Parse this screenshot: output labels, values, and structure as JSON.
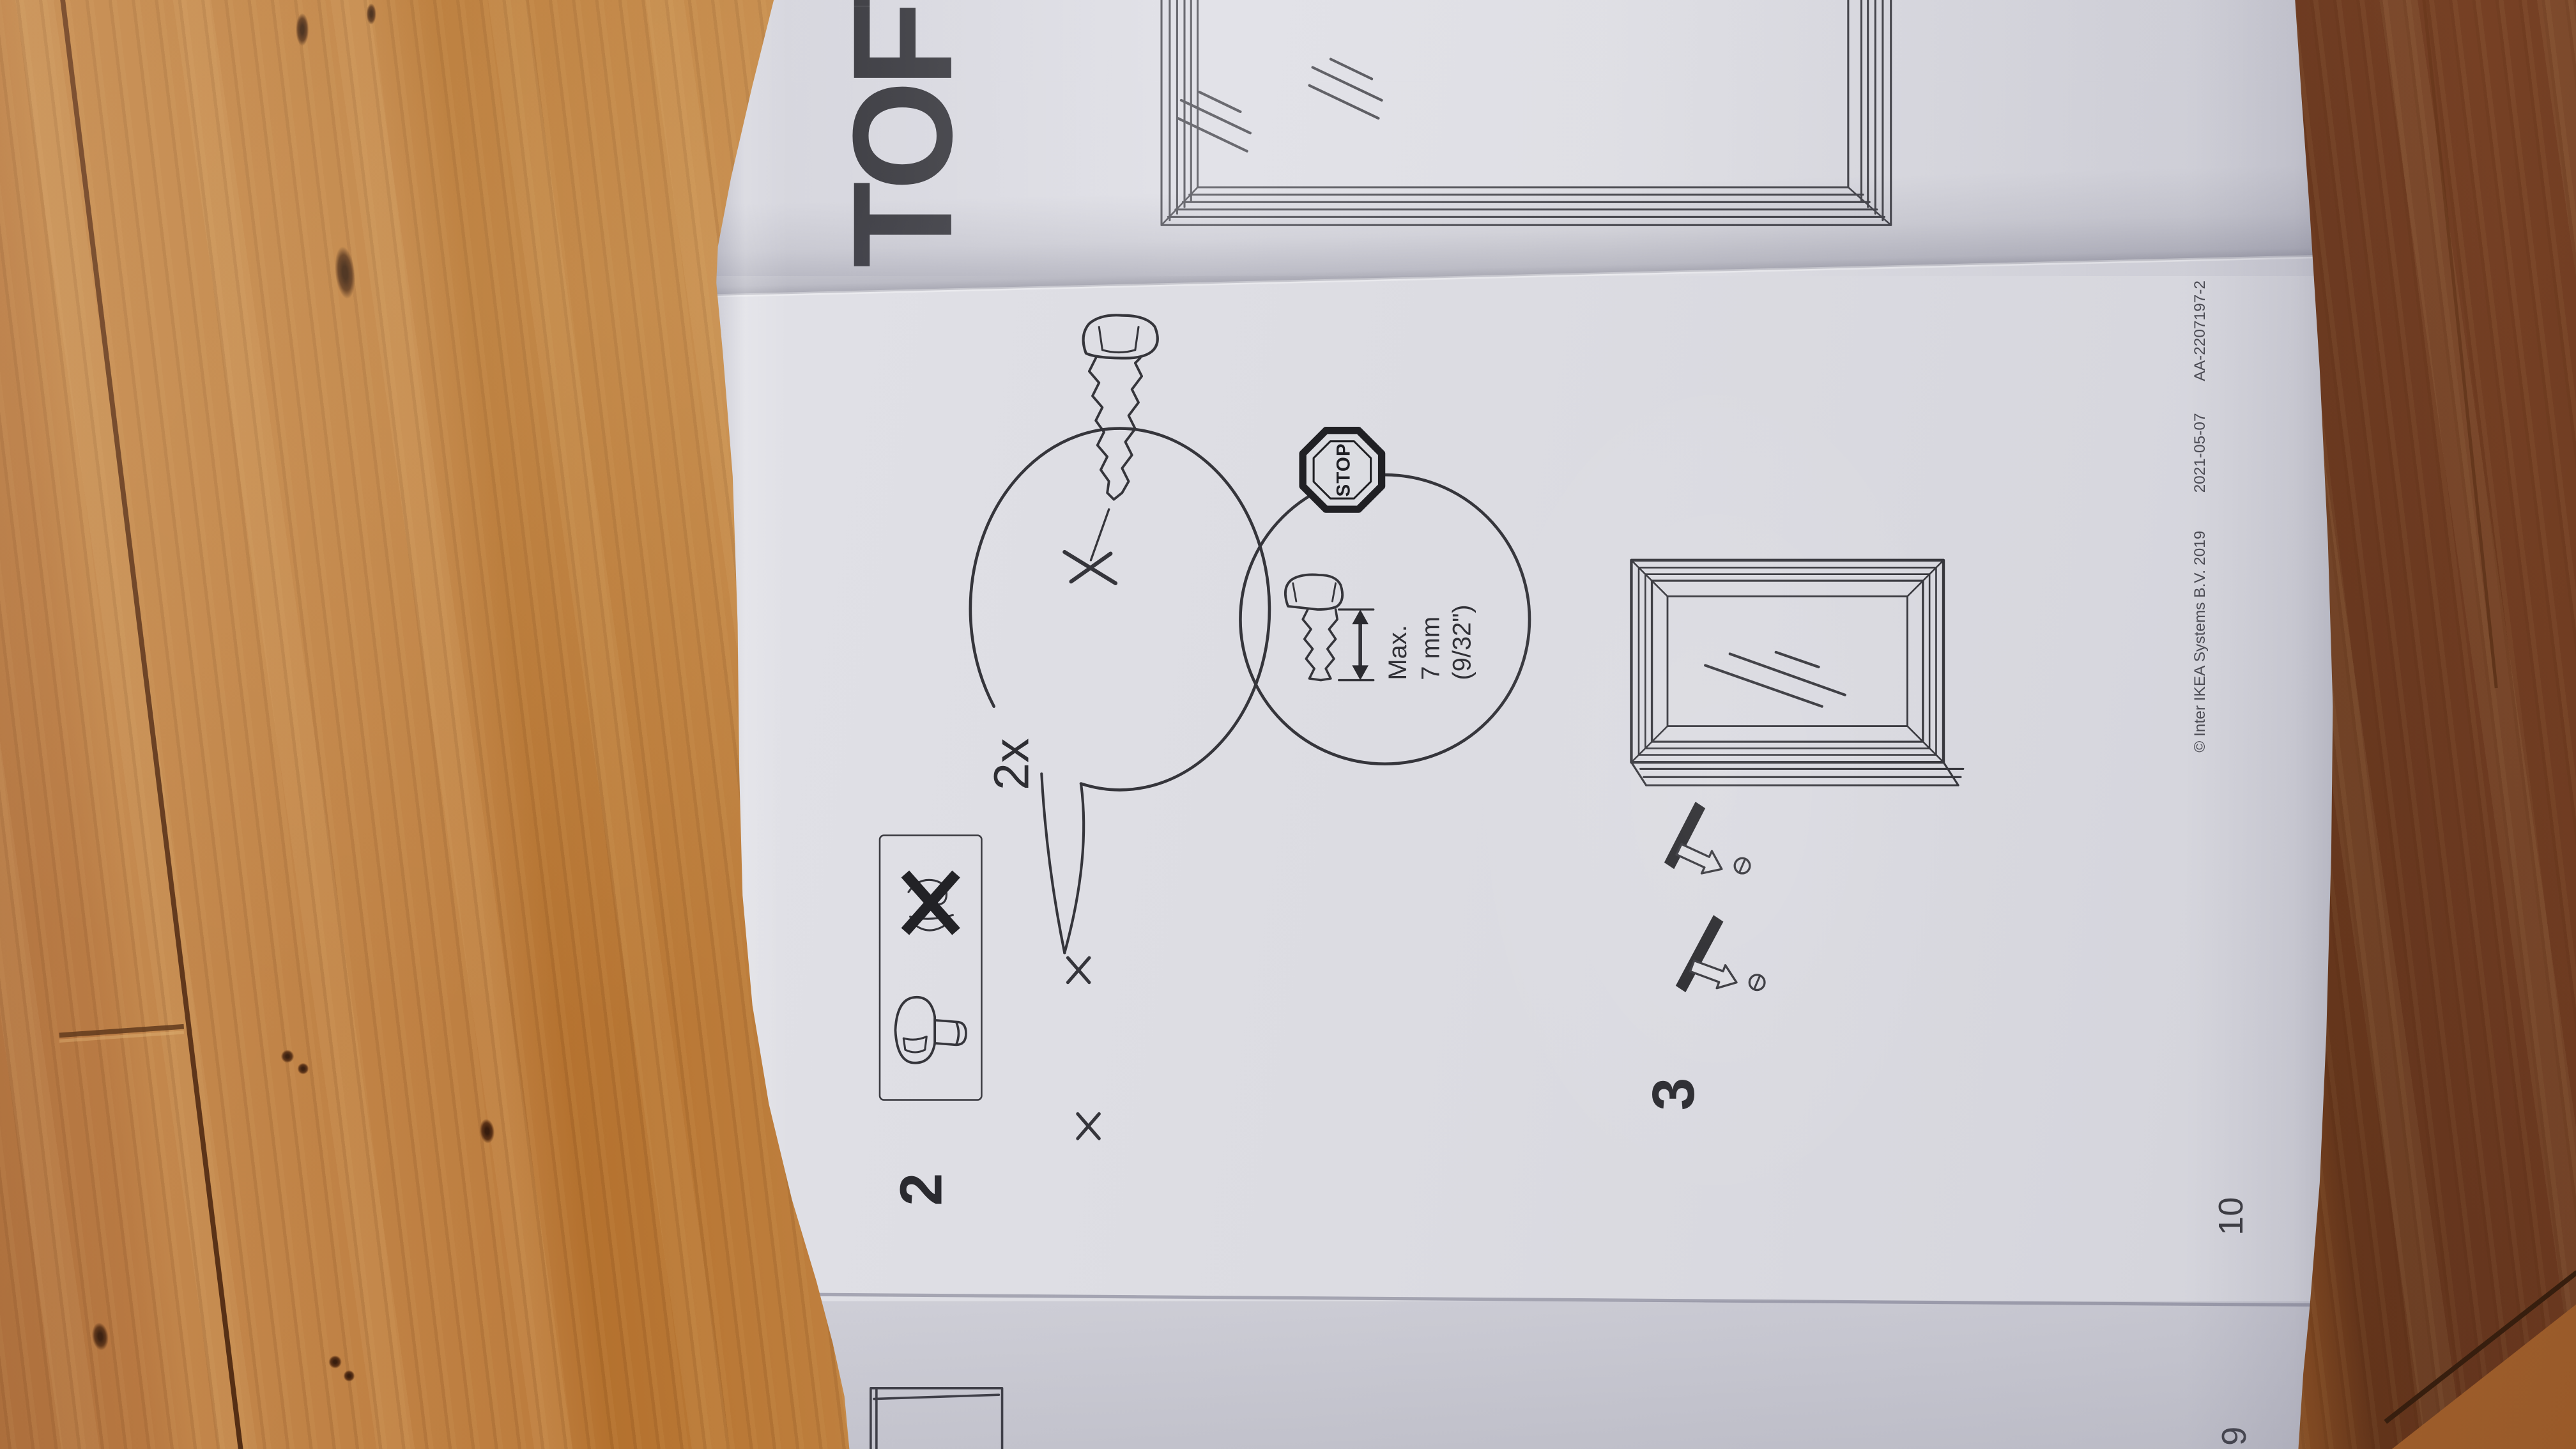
{
  "booklet": {
    "cover": {
      "title": "TOFT"
    },
    "step2": {
      "number": "2",
      "quantity_label": "2x",
      "stop_label": "STOP",
      "max_lines": [
        "Max.",
        "7 mm",
        "(9/32\")"
      ]
    },
    "step3": {
      "number": "3"
    },
    "pages": {
      "left_page_number": "10",
      "back_page_number": "9"
    },
    "footer": {
      "copyright": "© Inter IKEA Systems B.V. 2019",
      "date": "2021-05-07",
      "document_code": "AA-2207197-2"
    }
  },
  "icons": {
    "stop_sign": "double-outline octagon",
    "screw": "pan-head screw line drawing",
    "prohibited_fastener": "fastener sketch with thick X",
    "wall_mark": "small x cross",
    "magnifier_balloon": "detail circle with pointer tail",
    "depth_arrow": "double-headed arrow",
    "hang_arrow": "outlined arrow with hanger bar",
    "mirror_frame": "profiled rectangular frame with glass slashes"
  },
  "colors": {
    "paper": "#dddde2",
    "ink": "#35353b",
    "wood_light": "#c68a4a",
    "wood_mid": "#b4712e",
    "wood_dark": "#6b3a1e",
    "wood_seam": "#53290f"
  }
}
